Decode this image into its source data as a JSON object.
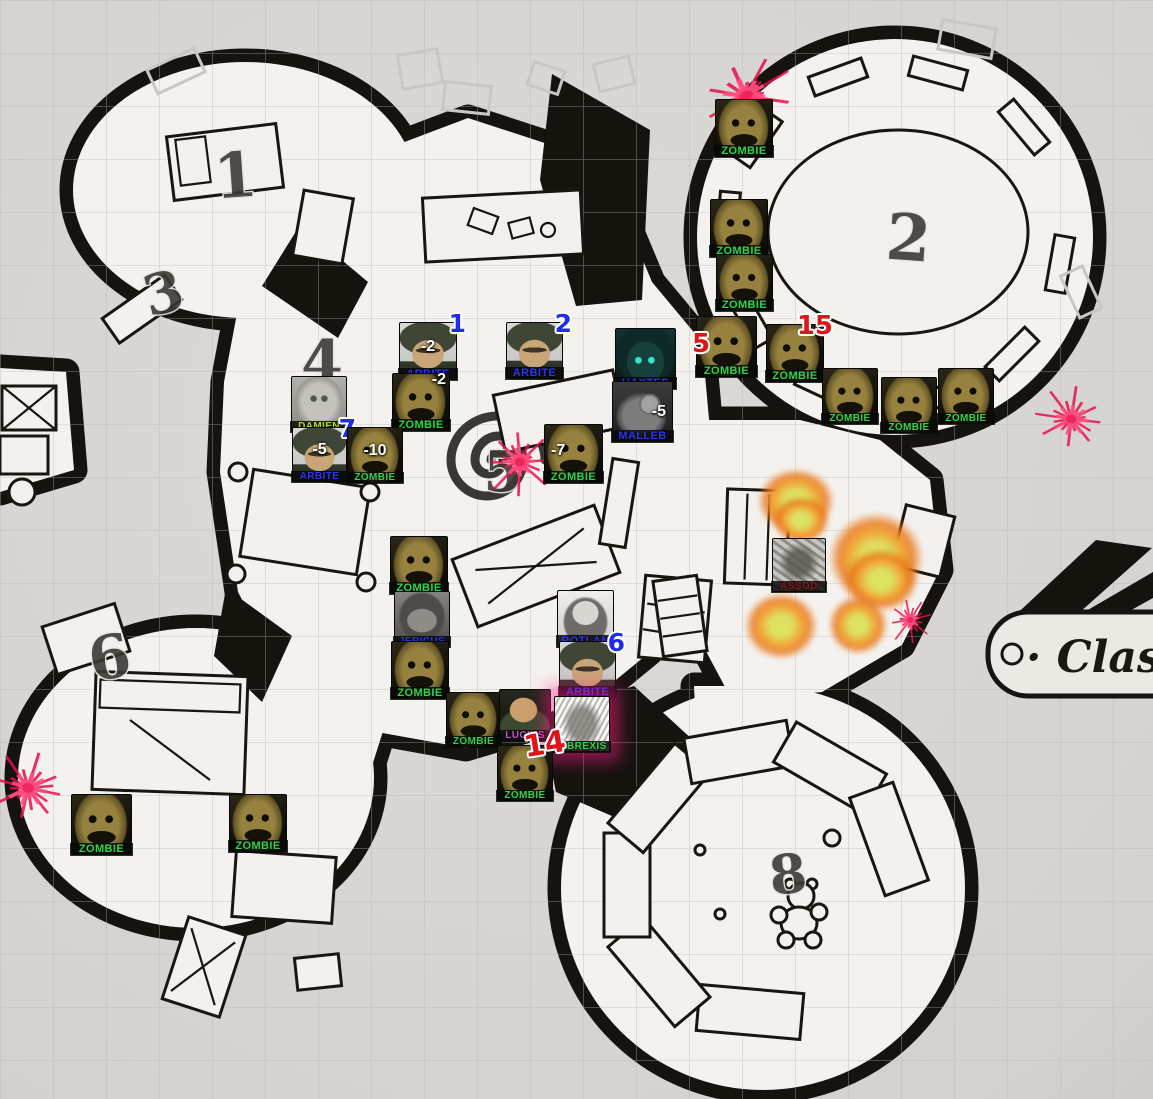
{
  "canvas": {
    "width": 1153,
    "height": 1099
  },
  "map": {
    "room_numbers": [
      {
        "text": "1",
        "x": 237,
        "y": 197,
        "size": 62,
        "rot": -4
      },
      {
        "text": "3",
        "x": 168,
        "y": 312,
        "size": 56,
        "rot": -14
      },
      {
        "text": "4",
        "x": 322,
        "y": 383,
        "size": 60,
        "rot": 0
      },
      {
        "text": "5",
        "x": 503,
        "y": 491,
        "size": 56,
        "rot": 0
      },
      {
        "text": "6",
        "x": 113,
        "y": 678,
        "size": 60,
        "rot": -10
      },
      {
        "text": "2",
        "x": 907,
        "y": 260,
        "size": 64,
        "rot": 4
      },
      {
        "text": "8",
        "x": 790,
        "y": 893,
        "size": 54,
        "rot": -6
      }
    ],
    "banner_text": "· Clas"
  },
  "label_colors": {
    "green": "#2fd44c",
    "blue": "#2b36f0",
    "lime": "#b5d822",
    "purple": "#c653cc",
    "darkred": "#8f1616"
  },
  "badge_colors": {
    "blue": "#1f2cee",
    "red": "#e01418"
  },
  "tokens": [
    {
      "id": "zombie-1",
      "label": "ZOMBIE",
      "type": "zombie",
      "color": "green",
      "x": 715,
      "y": 99,
      "size": 58
    },
    {
      "id": "zombie-2",
      "label": "ZOMBIE",
      "type": "zombie",
      "color": "green",
      "x": 710,
      "y": 199,
      "size": 58
    },
    {
      "id": "zombie-3",
      "label": "ZOMBIE",
      "type": "zombie",
      "color": "green",
      "x": 716,
      "y": 254,
      "size": 57
    },
    {
      "id": "zombie-4",
      "label": "ZOMBIE",
      "type": "zombie",
      "color": "green",
      "x": 696,
      "y": 316,
      "size": 61,
      "badge": {
        "text": "5",
        "color": "red",
        "pos": "ml"
      }
    },
    {
      "id": "zombie-5",
      "label": "ZOMBIE",
      "type": "zombie",
      "color": "green",
      "x": 766,
      "y": 324,
      "size": 58,
      "badge": {
        "text": "15",
        "color": "red",
        "pos": "tr"
      }
    },
    {
      "id": "zombie-6",
      "label": "ZOMBIE",
      "type": "zombie",
      "color": "green",
      "x": 822,
      "y": 368,
      "size": 56
    },
    {
      "id": "zombie-7",
      "label": "ZOMBIE",
      "type": "zombie",
      "color": "green",
      "x": 881,
      "y": 377,
      "size": 56
    },
    {
      "id": "zombie-8",
      "label": "ZOMBIE",
      "type": "zombie",
      "color": "green",
      "x": 938,
      "y": 368,
      "size": 56
    },
    {
      "id": "arbite-1",
      "label": "ARBITE",
      "type": "arbite",
      "color": "blue",
      "x": 399,
      "y": 322,
      "size": 58,
      "badge": {
        "text": "1",
        "color": "blue",
        "pos": "tr"
      },
      "value": {
        "text": "-2",
        "pos": "c"
      }
    },
    {
      "id": "arbite-2",
      "label": "ARBITE",
      "type": "arbite",
      "color": "blue",
      "x": 506,
      "y": 322,
      "size": 57,
      "badge": {
        "text": "2",
        "color": "blue",
        "pos": "tr"
      }
    },
    {
      "id": "zombie-9",
      "label": "ZOMBIE",
      "type": "zombie",
      "color": "green",
      "x": 392,
      "y": 373,
      "size": 58,
      "value": {
        "text": "-2",
        "pos": "tr"
      }
    },
    {
      "id": "haxtes",
      "label": "HAXTES",
      "type": "haxtes",
      "color": "blue",
      "x": 615,
      "y": 328,
      "size": 61
    },
    {
      "id": "malleb",
      "label": "MALLEB",
      "type": "malleb",
      "color": "blue",
      "x": 612,
      "y": 381,
      "size": 61,
      "value": {
        "text": "-5",
        "pos": "cr"
      }
    },
    {
      "id": "damien",
      "label": "DAMIEN",
      "type": "damien",
      "color": "lime",
      "x": 291,
      "y": 376,
      "size": 56
    },
    {
      "id": "arbite-3",
      "label": "ARBITE",
      "type": "arbite",
      "color": "blue",
      "x": 292,
      "y": 427,
      "size": 55,
      "badge": {
        "text": "7",
        "color": "blue",
        "pos": "tr"
      },
      "value": {
        "text": "-5",
        "pos": "c"
      }
    },
    {
      "id": "zombie-10",
      "label": "ZOMBIE",
      "type": "zombie",
      "color": "green",
      "x": 347,
      "y": 427,
      "size": 56,
      "value": {
        "text": "-10",
        "pos": "c"
      }
    },
    {
      "id": "zombie-11",
      "label": "ZOMBIE",
      "type": "zombie",
      "color": "green",
      "x": 544,
      "y": 424,
      "size": 59,
      "value": {
        "text": "-7",
        "pos": "cl"
      }
    },
    {
      "id": "zombie-12",
      "label": "ZOMBIE",
      "type": "zombie",
      "color": "green",
      "x": 390,
      "y": 536,
      "size": 58
    },
    {
      "id": "jericus",
      "label": "JERICUS",
      "type": "jericus",
      "color": "blue",
      "x": 394,
      "y": 591,
      "size": 56
    },
    {
      "id": "zombie-13",
      "label": "ZOMBIE",
      "type": "zombie",
      "color": "green",
      "x": 391,
      "y": 641,
      "size": 58
    },
    {
      "id": "rotlan",
      "label": "ROTLAN",
      "type": "rotlan",
      "color": "blue",
      "x": 557,
      "y": 590,
      "size": 57
    },
    {
      "id": "arbite-4",
      "label": "ARBITE",
      "type": "arbite",
      "color": "blue",
      "x": 559,
      "y": 641,
      "size": 57,
      "badge": {
        "text": "6",
        "color": "blue",
        "pos": "tr"
      }
    },
    {
      "id": "zombie-14",
      "label": "ZOMBIE",
      "type": "zombie",
      "color": "green",
      "x": 446,
      "y": 692,
      "size": 55
    },
    {
      "id": "lucius",
      "label": "LUCIUS",
      "type": "lucius",
      "color": "purple",
      "x": 499,
      "y": 689,
      "size": 52
    },
    {
      "id": "tibrexis",
      "label": "TIBREXIS",
      "type": "tibrexis",
      "color": "green",
      "x": 554,
      "y": 696,
      "size": 56,
      "glow": "pink"
    },
    {
      "id": "zombie-15",
      "label": "ZOMBIE",
      "type": "zombie",
      "color": "green",
      "x": 497,
      "y": 745,
      "size": 56,
      "badge": {
        "text": "14",
        "color": "red",
        "pos": "trr"
      }
    },
    {
      "id": "zombie-16",
      "label": "ZOMBIE",
      "type": "zombie",
      "color": "green",
      "x": 71,
      "y": 794,
      "size": 61
    },
    {
      "id": "zombie-17",
      "label": "ZOMBIE",
      "type": "zombie",
      "color": "green",
      "x": 229,
      "y": 794,
      "size": 58
    },
    {
      "id": "assod",
      "label": "ASSOD",
      "type": "assod",
      "color": "darkred",
      "x": 772,
      "y": 538,
      "size": 54
    }
  ],
  "effects": {
    "fire_core": "#dde263",
    "fire_mid": "#f2a437",
    "fire_edge": "#e87416",
    "spike_color": "#e50f4d",
    "spike_inner": "#ff4f7f",
    "fires": [
      {
        "x": 757,
        "y": 468,
        "w": 78,
        "h": 66
      },
      {
        "x": 772,
        "y": 496,
        "w": 58,
        "h": 48
      },
      {
        "x": 828,
        "y": 512,
        "w": 96,
        "h": 92
      },
      {
        "x": 843,
        "y": 548,
        "w": 76,
        "h": 64
      },
      {
        "x": 744,
        "y": 592,
        "w": 74,
        "h": 68
      },
      {
        "x": 828,
        "y": 595,
        "w": 60,
        "h": 60
      }
    ],
    "spikes": [
      {
        "x": 686,
        "y": 56,
        "size": 80,
        "rot": -28,
        "stretch": 1.5
      },
      {
        "x": 1028,
        "y": 383,
        "size": 72,
        "rot": 10,
        "stretch": 1.2
      },
      {
        "x": 478,
        "y": 424,
        "size": 76,
        "rot": 0,
        "stretch": 1.1
      },
      {
        "x": -20,
        "y": 748,
        "size": 80,
        "rot": 15,
        "stretch": 1.2
      },
      {
        "x": 884,
        "y": 594,
        "size": 52,
        "rot": -10,
        "stretch": 1.0
      }
    ]
  }
}
